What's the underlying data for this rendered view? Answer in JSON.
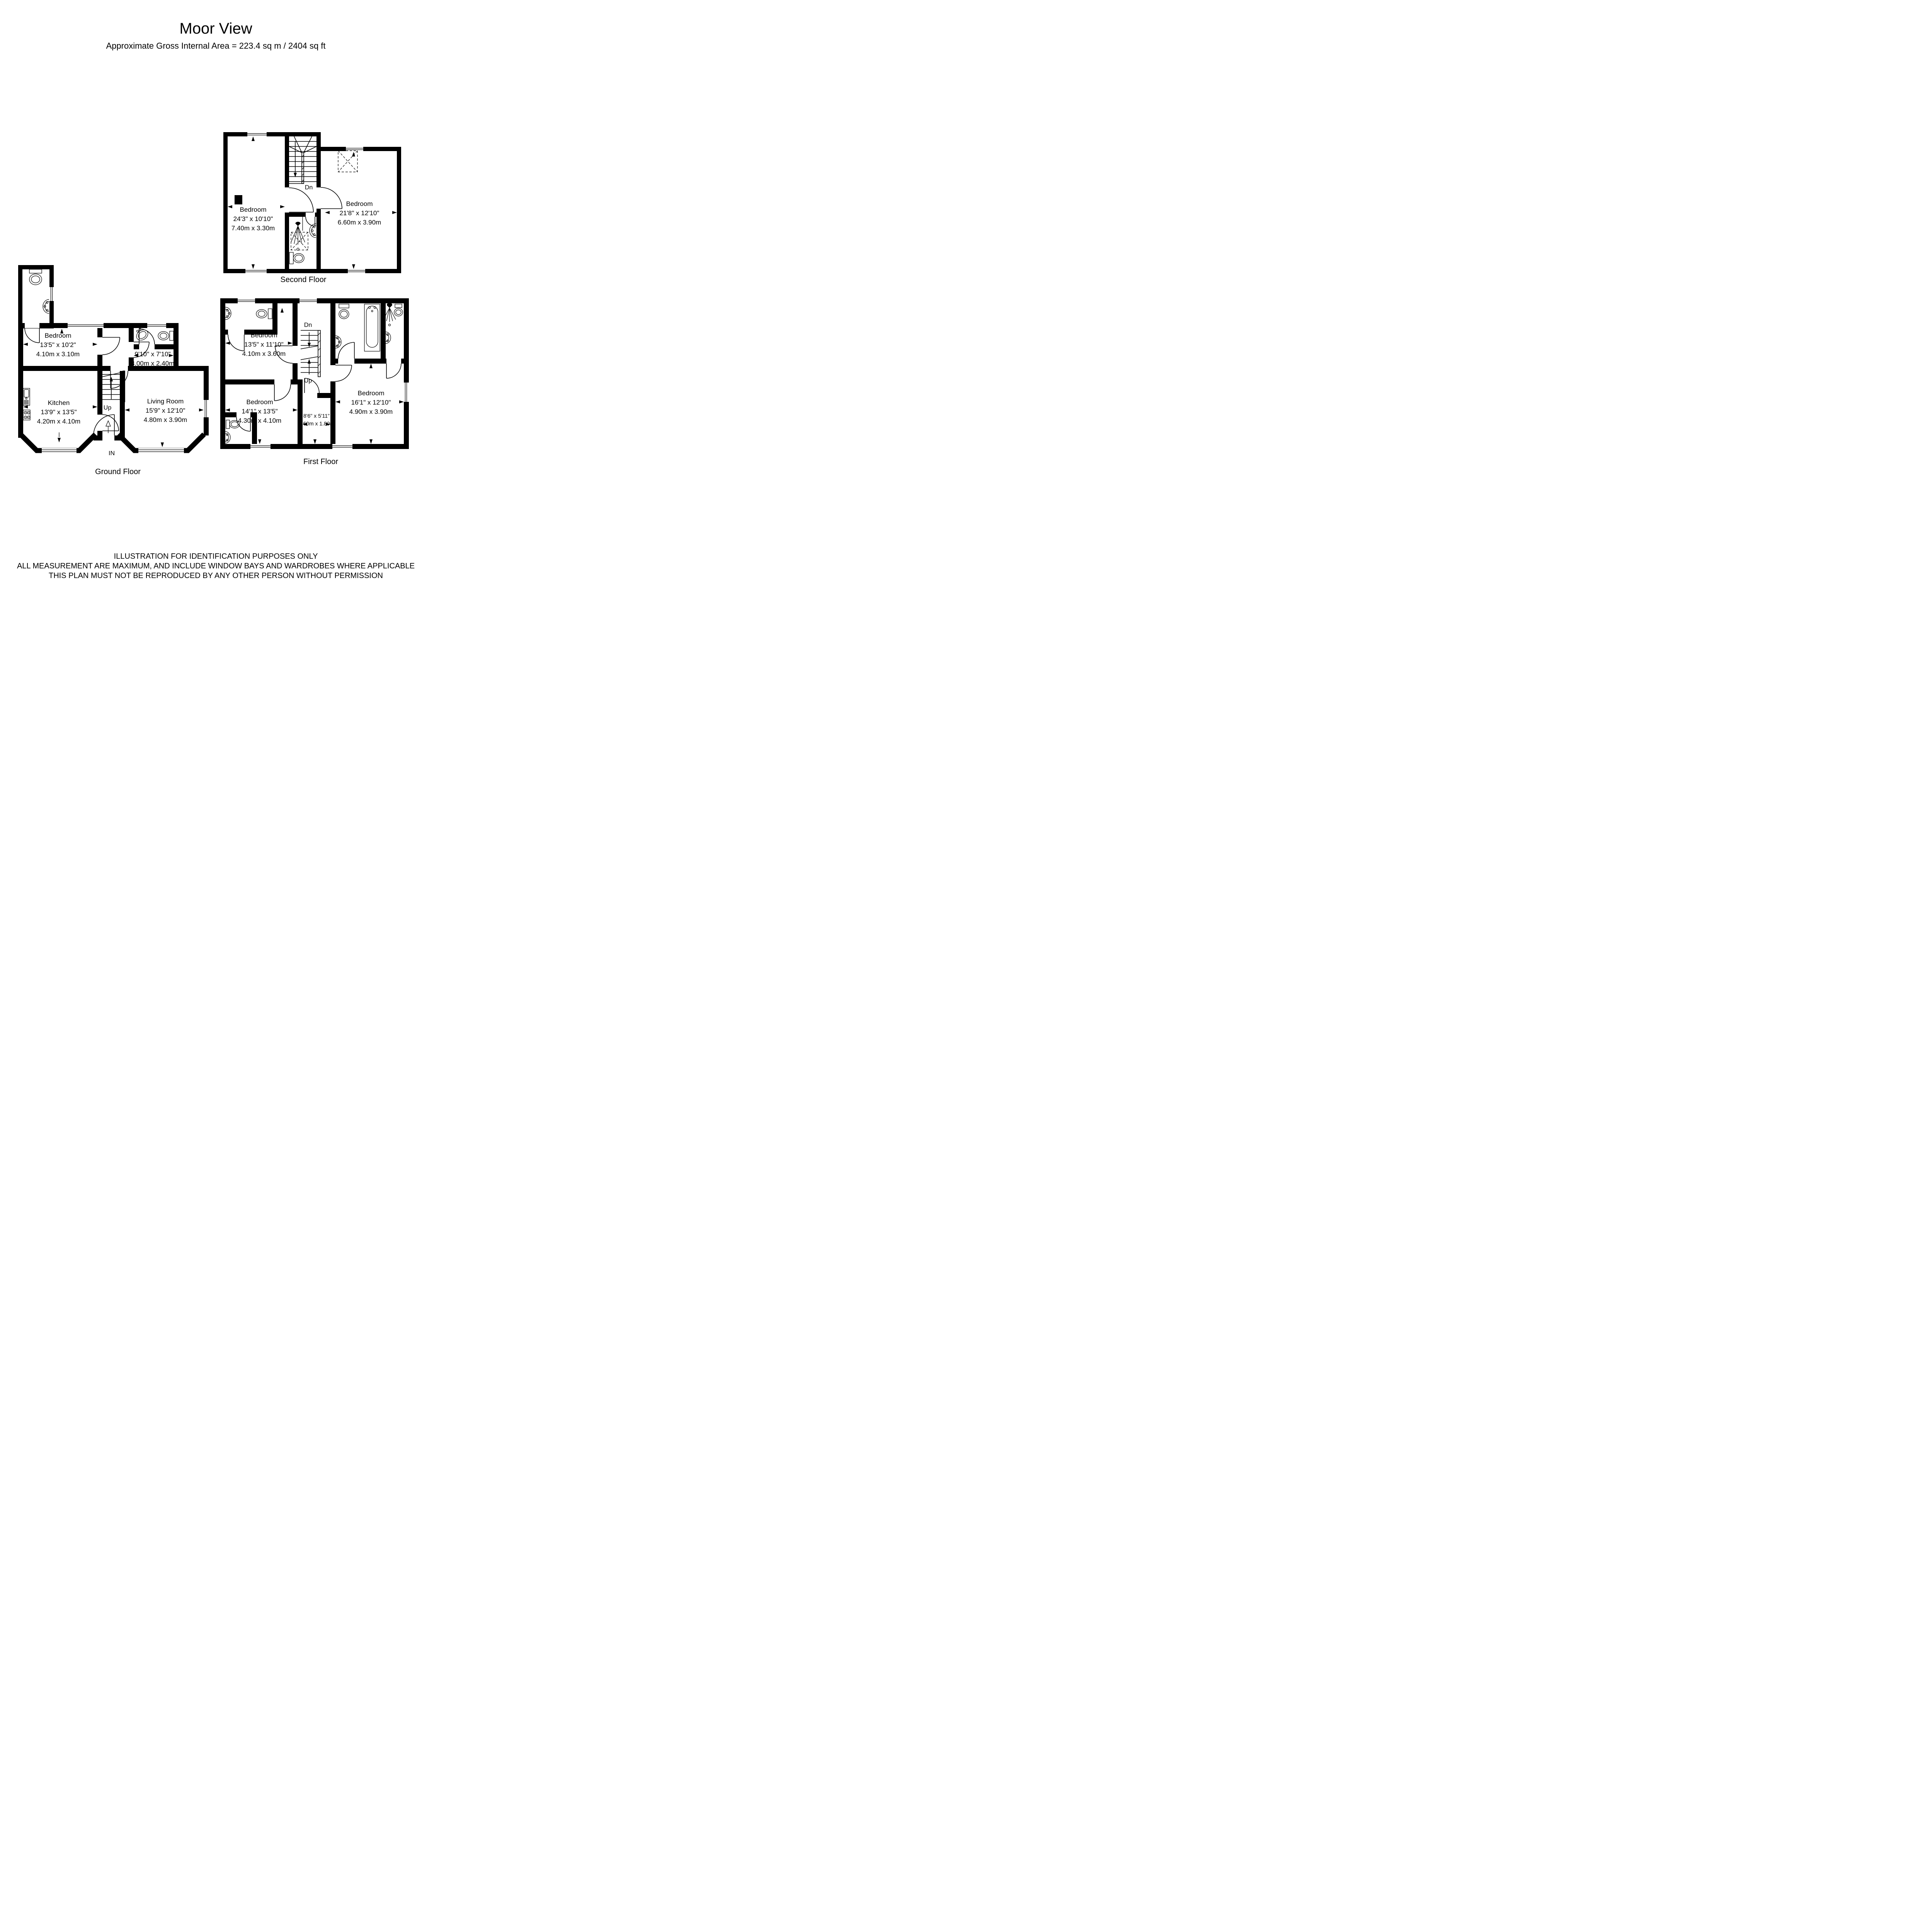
{
  "page": {
    "title": "Moor View",
    "subtitle": "Approximate Gross Internal Area = 223.4 sq m / 2404 sq ft"
  },
  "floors": {
    "second": {
      "caption": "Second Floor",
      "stairs": {
        "dn": "Dn"
      },
      "rooms": {
        "bedroom_left": {
          "name": "Bedroom",
          "imperial": "24'3\" x 10'10\"",
          "metric": "7.40m x 3.30m"
        },
        "bedroom_right": {
          "name": "Bedroom",
          "imperial": "21'8\" x 12'10\"",
          "metric": "6.60m x 3.90m"
        }
      }
    },
    "ground": {
      "caption": "Ground Floor",
      "entrance": "IN",
      "stairs": {
        "up": "Up"
      },
      "rooms": {
        "bedroom": {
          "name": "Bedroom",
          "imperial": "13'5\" x 10'2\"",
          "metric": "4.10m x 3.10m"
        },
        "store": {
          "name": "",
          "imperial": "9'10\" x 7'10\"",
          "metric": "3.00m x 2.40m"
        },
        "kitchen": {
          "name": "Kitchen",
          "imperial": "13'9\" x 13'5\"",
          "metric": "4.20m x 4.10m"
        },
        "living_room": {
          "name": "Living Room",
          "imperial": "15'9\" x 12'10\"",
          "metric": "4.80m x 3.90m"
        }
      }
    },
    "first": {
      "caption": "First Floor",
      "stairs": {
        "dn": "Dn",
        "up": "Up"
      },
      "rooms": {
        "bedroom_top": {
          "name": "Bedroom",
          "imperial": "13'5\" x 11'10\"",
          "metric": "4.10m x 3.60m"
        },
        "bedroom_left": {
          "name": "Bedroom",
          "imperial": "14'1\" x 13'5\"",
          "metric": "4.30m x 4.10m"
        },
        "store": {
          "name": "",
          "imperial": "8'6\" x 5'11\"",
          "metric": "2.60m x 1.80m"
        },
        "bedroom_right": {
          "name": "Bedroom",
          "imperial": "16'1\" x 12'10\"",
          "metric": "4.90m x 3.90m"
        }
      }
    }
  },
  "disclaimer": {
    "line1": "ILLUSTRATION FOR IDENTIFICATION PURPOSES ONLY",
    "line2": "ALL MEASUREMENT  ARE MAXIMUM, AND INCLUDE WINDOW BAYS AND WARDROBES WHERE APPLICABLE",
    "line3": "THIS PLAN MUST NOT BE REPRODUCED BY ANY OTHER PERSON WITHOUT PERMISSION"
  },
  "colors": {
    "wall": "#000000",
    "background": "#ffffff"
  }
}
